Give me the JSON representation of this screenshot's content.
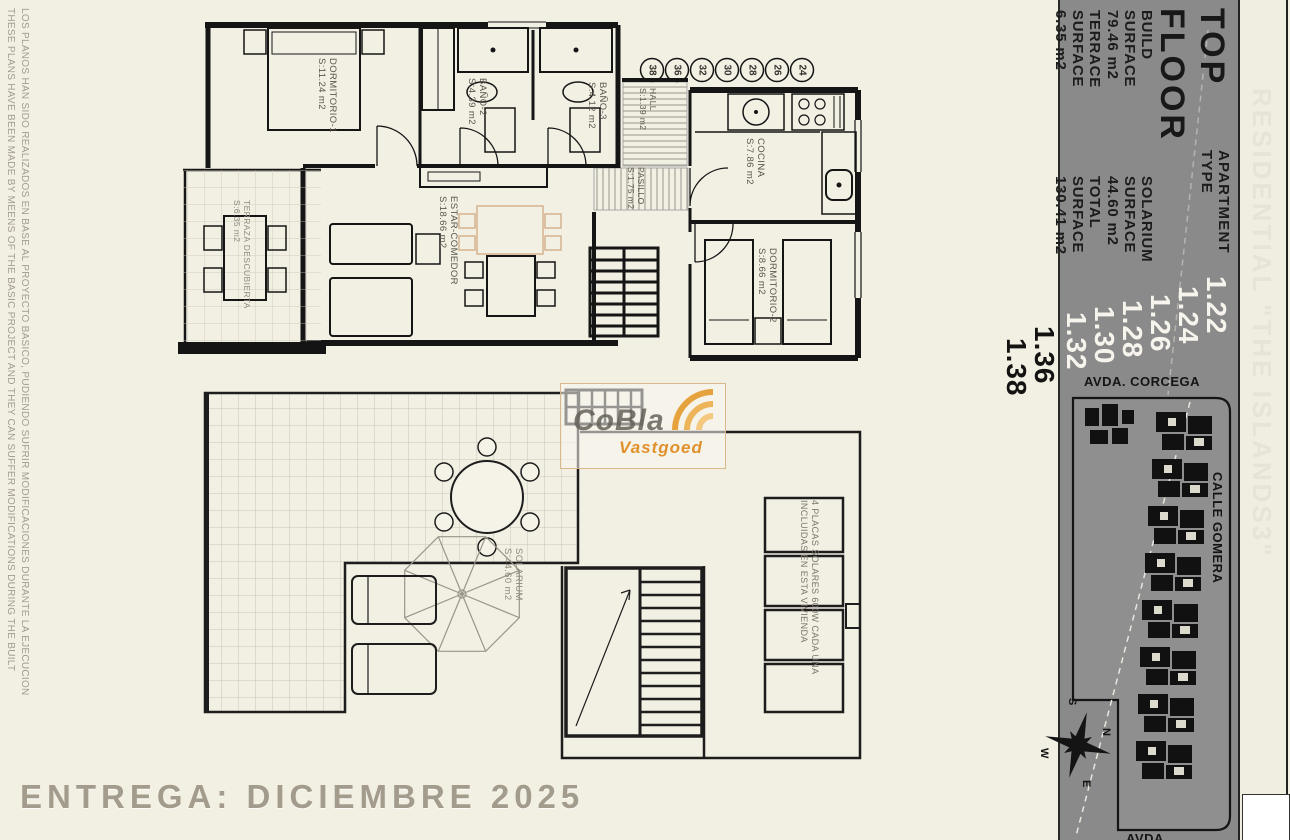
{
  "disclaimer": {
    "en": "THESE PLANS HAVE BEEN MADE BY MEENS OF THE BASIC PROJECT AND THEY CAN SUFFER MODIFICATIONS DURING THE BUILT",
    "es": "LOS PLANOS HAN SIDO REALIZADOS EN BASE AL PROYECTO BASICO, PUDIENDO SUFRIR MODIFICACIONES DURANTE LA EJECUCION"
  },
  "delivery": {
    "text": "ENTREGA: DICIEMBRE 2025"
  },
  "watermark": {
    "line1": "CoBla",
    "line2": "Vastgoed"
  },
  "strip": {
    "text": "RESIDENTIAL \"THE ISLANDS3\""
  },
  "panel": {
    "floor": {
      "l1": "TOP",
      "l2": "FLOOR"
    },
    "apartment": {
      "l1": "APARTMENT",
      "l2": "TYPE"
    },
    "numbers_white": [
      "1.22",
      "1.24",
      "1.26",
      "1.28",
      "1.30",
      "1.32"
    ],
    "numbers_black": [
      "1.36",
      "1.38"
    ],
    "surfaces": [
      {
        "l1": "BUILD",
        "l2": "SURFACE",
        "value": "79.46 m2"
      },
      {
        "l1": "TERRACE",
        "l2": "SURFACE",
        "value": "6.35 m2"
      },
      {
        "l1": "SOLARIUM",
        "l2": "SURFACE",
        "value": "44.60 m2"
      },
      {
        "l1": "TOTAL",
        "l2": "SURFACE",
        "value": "130.41 m2"
      }
    ]
  },
  "site": {
    "street_top": "AVDA. CORCEGA",
    "street_right": "CALLE GOMERA",
    "street_bottom": "AVDA.",
    "compass": {
      "n": "N",
      "s": "S",
      "e": "E",
      "w": "W"
    }
  },
  "rooms": {
    "dormitorio1": {
      "name": "DORMITORIO-1",
      "area": "S:11.24 m2"
    },
    "bano2": {
      "name": "BAÑO-2",
      "area": "S:4.39 m2"
    },
    "bano3": {
      "name": "BAÑO-3",
      "area": "S:4.12 m2"
    },
    "hall": {
      "name": "HALL",
      "area": "S:1.39 m2"
    },
    "pasillo": {
      "name": "PASILLO",
      "area": "S:1.75 m2"
    },
    "cocina": {
      "name": "COCINA",
      "area": "S:7.86 m2"
    },
    "estar": {
      "name": "ESTAR-COMEDOR",
      "area": "S:18.66 m2"
    },
    "dormitorio2": {
      "name": "DORMITORIO-2",
      "area": "S:8.66 m2"
    },
    "terraza": {
      "name": "TERRAZA DESCUBIERTA",
      "area": "S:6.35 m2"
    },
    "solarium": {
      "name": "SOLARIUM",
      "area": "S:44.60 m2"
    }
  },
  "circles": [
    "38",
    "36",
    "32",
    "30",
    "28",
    "26",
    "24"
  ],
  "notes": {
    "solar": {
      "l1": "4 PLACAS SOLARES 600W CADA UNA",
      "l2": "INCLUIDAS EN ESTA VIVIENDA"
    }
  }
}
